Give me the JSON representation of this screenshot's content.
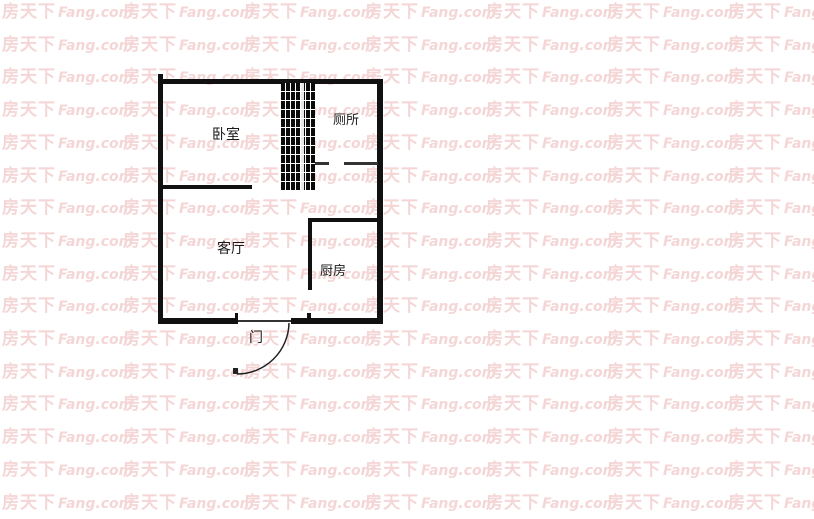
{
  "watermark": {
    "brand_cjk": "房天下",
    "brand_latin": "Fang.com",
    "color": "#f5d6d6"
  },
  "floorplan": {
    "wall_color": "#111111",
    "background": "#ffffff",
    "labels": {
      "bedroom": "卧室",
      "toilet": "厕所",
      "living_room": "客厅",
      "kitchen": "厨房",
      "door": "门"
    }
  }
}
